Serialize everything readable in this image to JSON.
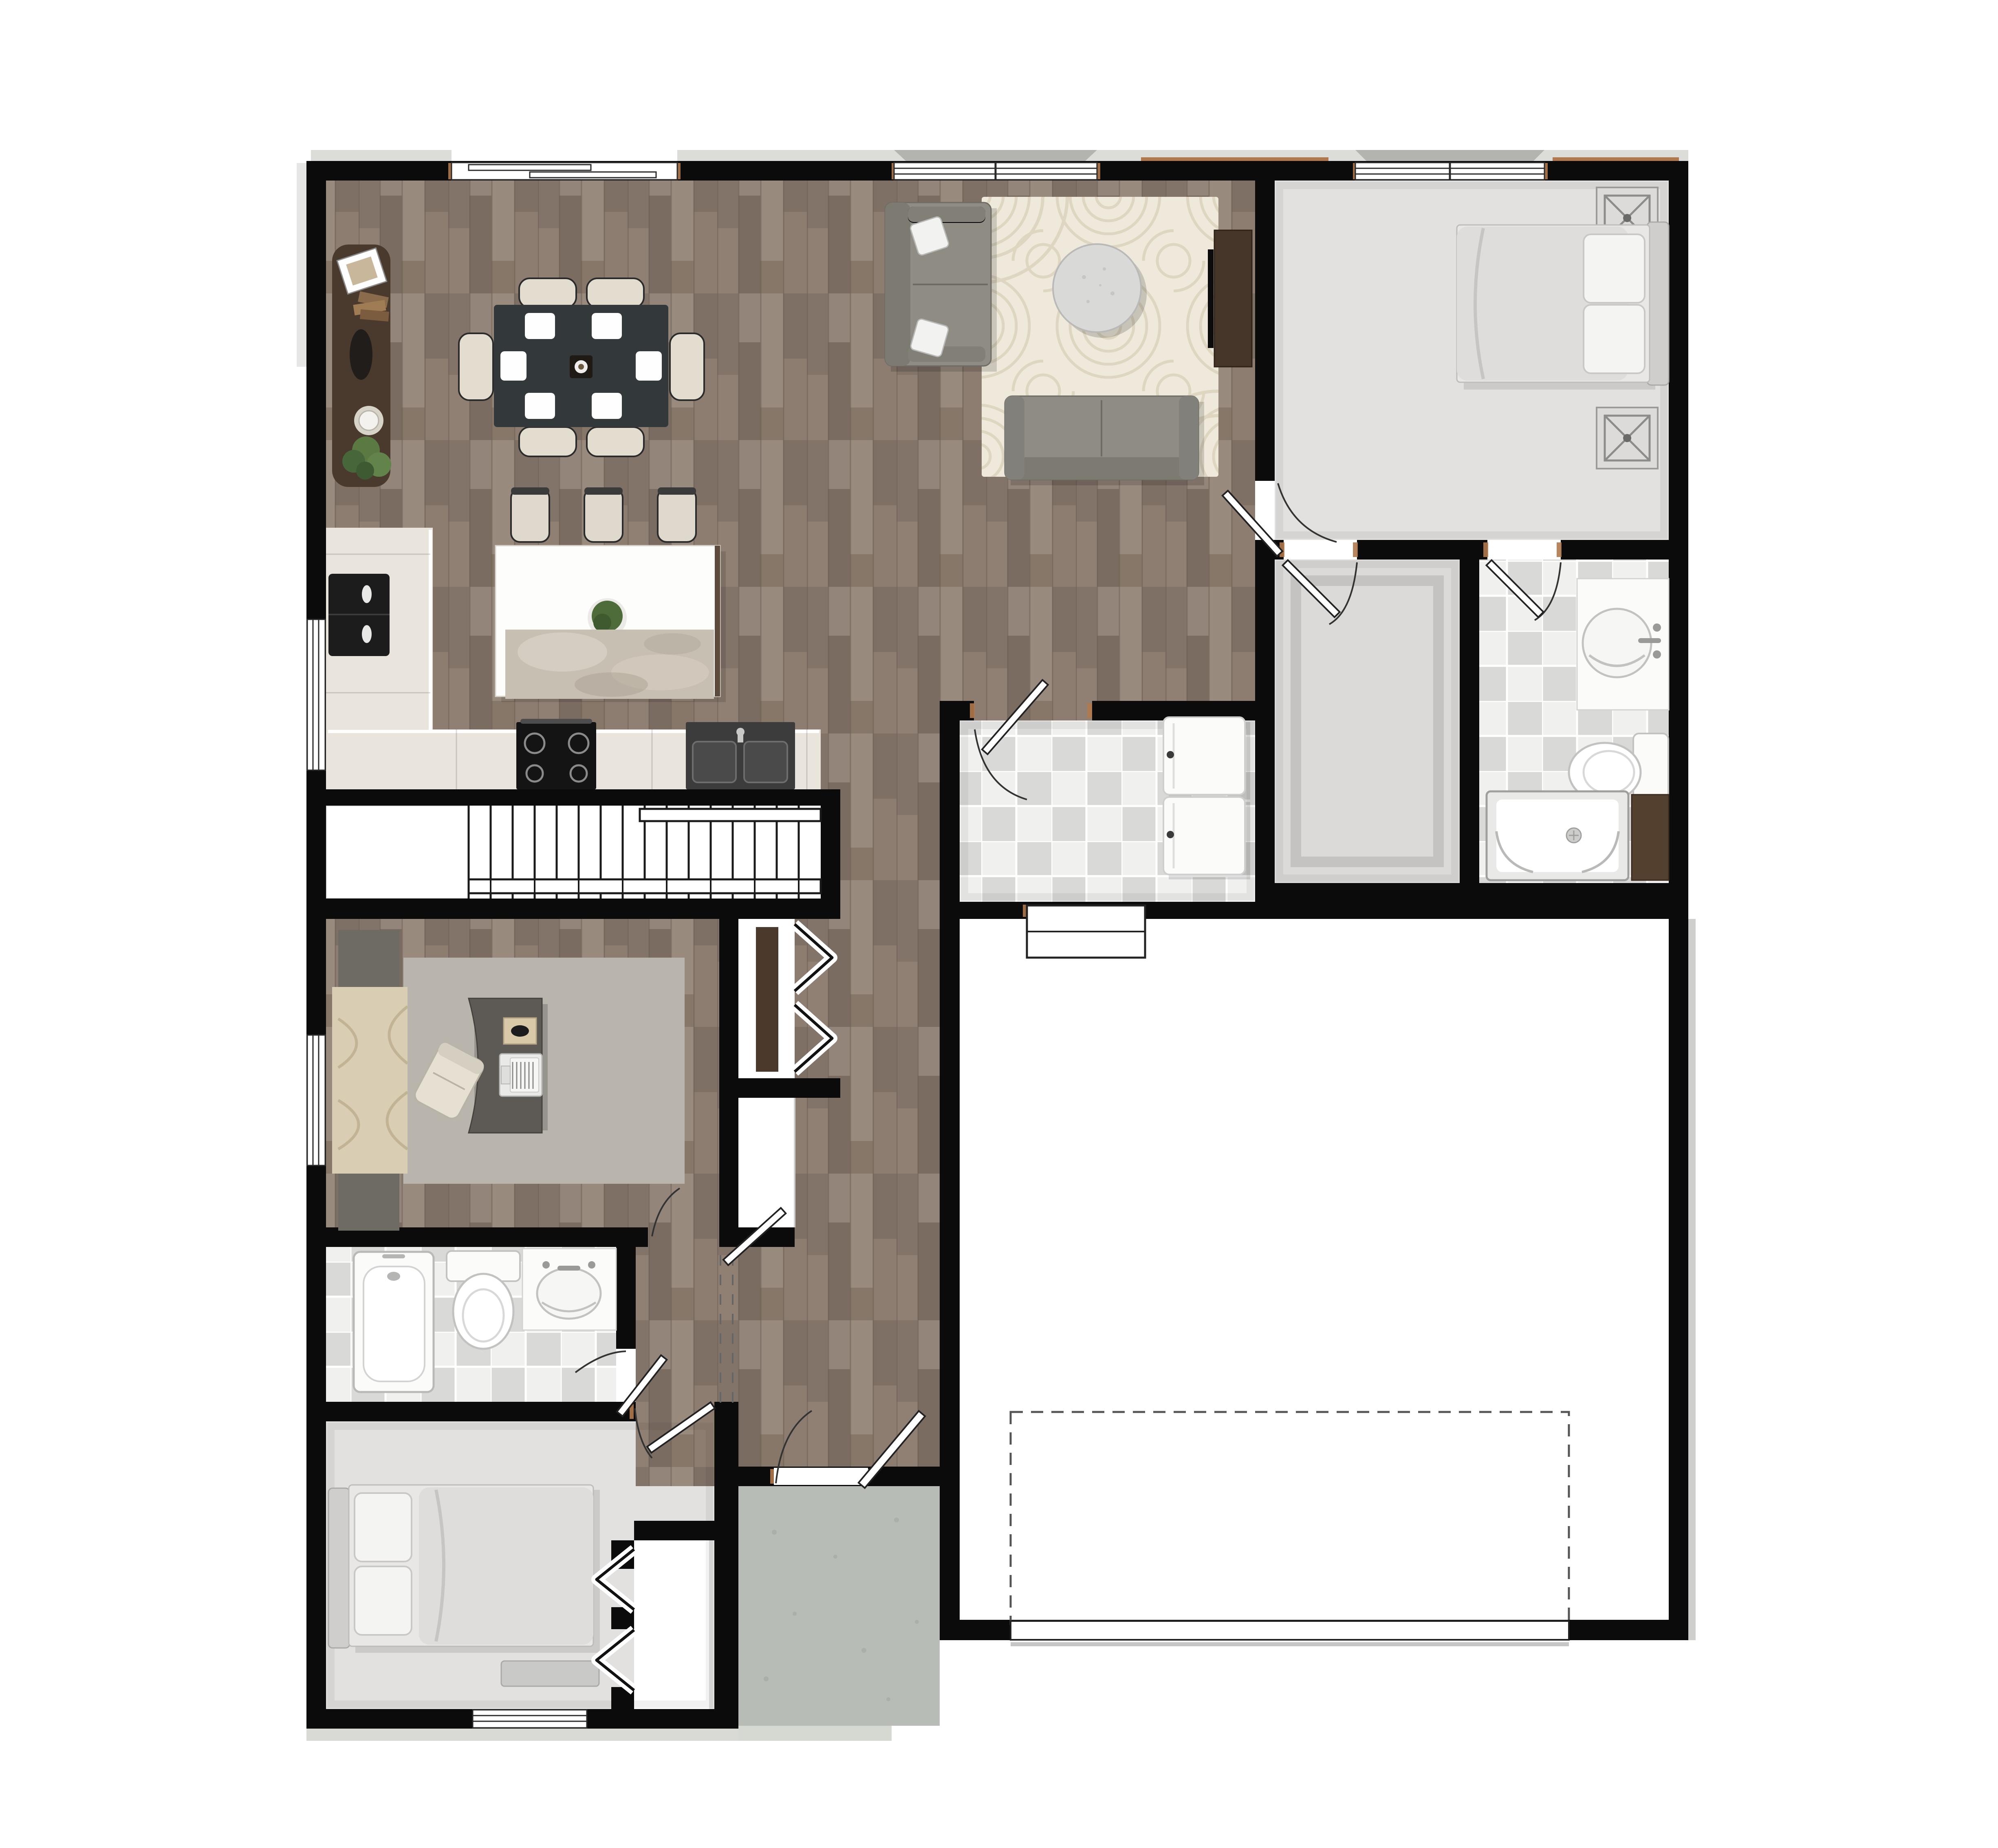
{
  "meta": {
    "title": "Single-story home color floor plan rendering",
    "view": "top-down",
    "text_labels": "none visible"
  },
  "palette": {
    "wall": "#0b0b0b",
    "wood_floor_base": "#8a7b6f",
    "wood_plank_light": "#998a7e",
    "wood_plank_dark": "#7b6c62",
    "carpet": "#e2e1df",
    "tile_light": "#efefee",
    "tile_gray": "#d9d9d8",
    "counter_beige": "#e9e5dd",
    "island_white": "#fdfdfc",
    "appliance_black": "#1c1c1c",
    "sofa_gray": "#8f8c84",
    "rug_cream": "#eee9db",
    "rug_line": "#ded6c1",
    "office_rug_gray": "#b9b5ac",
    "desk_gray": "#5d5a55",
    "console_brown": "#4a3a2d",
    "linen_brown": "#54402f",
    "porch_concrete": "#b8bcb6",
    "eave_gray": "#dcdcd8",
    "jamb_tan": "#b0794d",
    "dashed_outline": "#555555"
  },
  "rooms": [
    {
      "id": "dining",
      "name": "dining area",
      "floor": "wood",
      "fixtures": [
        "dining table",
        "6 chairs",
        "6 placemats",
        "centerpiece bowl",
        "sideboard console",
        "plant",
        "candle",
        "decor tray",
        "picture frame"
      ]
    },
    {
      "id": "kitchen",
      "name": "kitchen",
      "floor": "wood",
      "fixtures": [
        "L-shaped counter",
        "black refrigerator",
        "range with 4 burners",
        "sink with faucet",
        "island",
        "3 bar stools",
        "island plant",
        "runner rug"
      ]
    },
    {
      "id": "living",
      "name": "living room",
      "floor": "wood",
      "fixtures": [
        "sofa with 2 pillows",
        "loveseat",
        "round coffee table",
        "patterned area rug",
        "media console",
        "TV"
      ]
    },
    {
      "id": "master-bedroom",
      "name": "master bedroom",
      "floor": "carpet",
      "fixtures": [
        "bed with 2 pillows",
        "2 nightstands with lamps"
      ]
    },
    {
      "id": "walk-in-closet",
      "name": "walk-in closet",
      "floor": "carpet",
      "fixtures": [
        "swing door"
      ]
    },
    {
      "id": "master-bath",
      "name": "master bathroom",
      "floor": "checker tile",
      "fixtures": [
        "vanity with round sink",
        "toilet",
        "shower with drain",
        "linen closet",
        "swing door"
      ]
    },
    {
      "id": "laundry",
      "name": "laundry room",
      "floor": "checker tile",
      "fixtures": [
        "washer",
        "dryer",
        "swing door",
        "garage man-door"
      ]
    },
    {
      "id": "garage",
      "name": "garage",
      "floor": "concrete-white",
      "fixtures": [
        "dashed door-clearance outline",
        "garage door",
        "man-door"
      ]
    },
    {
      "id": "office",
      "name": "office / den",
      "floor": "wood",
      "fixtures": [
        "curved desk",
        "laptop",
        "desk tray",
        "office chair",
        "area rug",
        "window drapes",
        "credenza blocks",
        "swing door"
      ]
    },
    {
      "id": "bath-2",
      "name": "second bathroom",
      "floor": "checker tile",
      "fixtures": [
        "bathtub",
        "toilet",
        "vanity with oval sink",
        "swing door"
      ]
    },
    {
      "id": "bedroom-2",
      "name": "second bedroom",
      "floor": "carpet",
      "fixtures": [
        "bed with 2 pillows",
        "bi-fold closet",
        "window bench",
        "swing door"
      ]
    },
    {
      "id": "hall",
      "name": "hallway / foyer",
      "floor": "wood",
      "fixtures": [
        "bi-fold hall closet",
        "pantry nook",
        "front door",
        "dashed ceiling-break lines"
      ]
    },
    {
      "id": "stairs",
      "name": "staircase",
      "floor": "treads",
      "fixtures": [
        "treads",
        "handrail",
        "balusters",
        "under-stair void"
      ]
    },
    {
      "id": "porch",
      "name": "entry porch",
      "floor": "concrete",
      "fixtures": []
    }
  ],
  "windows": [
    {
      "wall": "top",
      "room": "dining",
      "style": "offset slider"
    },
    {
      "wall": "top",
      "room": "living",
      "style": "two-panel"
    },
    {
      "wall": "top",
      "room": "master-bedroom",
      "style": "two-panel"
    },
    {
      "wall": "left",
      "room": "kitchen"
    },
    {
      "wall": "left",
      "room": "office"
    },
    {
      "wall": "bottom",
      "room": "bedroom-2"
    }
  ],
  "doors": [
    {
      "room": "front entry",
      "type": "swing"
    },
    {
      "room": "master-bedroom",
      "type": "swing"
    },
    {
      "room": "walk-in-closet",
      "type": "swing"
    },
    {
      "room": "master-bath",
      "type": "swing"
    },
    {
      "room": "laundry",
      "type": "swing"
    },
    {
      "room": "garage man-door",
      "type": "panel"
    },
    {
      "room": "garage vehicle door",
      "type": "overhead"
    },
    {
      "room": "office",
      "type": "swing"
    },
    {
      "room": "bath-2",
      "type": "swing"
    },
    {
      "room": "bedroom-2",
      "type": "swing"
    },
    {
      "room": "hall closet",
      "type": "bi-fold"
    },
    {
      "room": "bedroom-2 closet",
      "type": "bi-fold"
    }
  ]
}
